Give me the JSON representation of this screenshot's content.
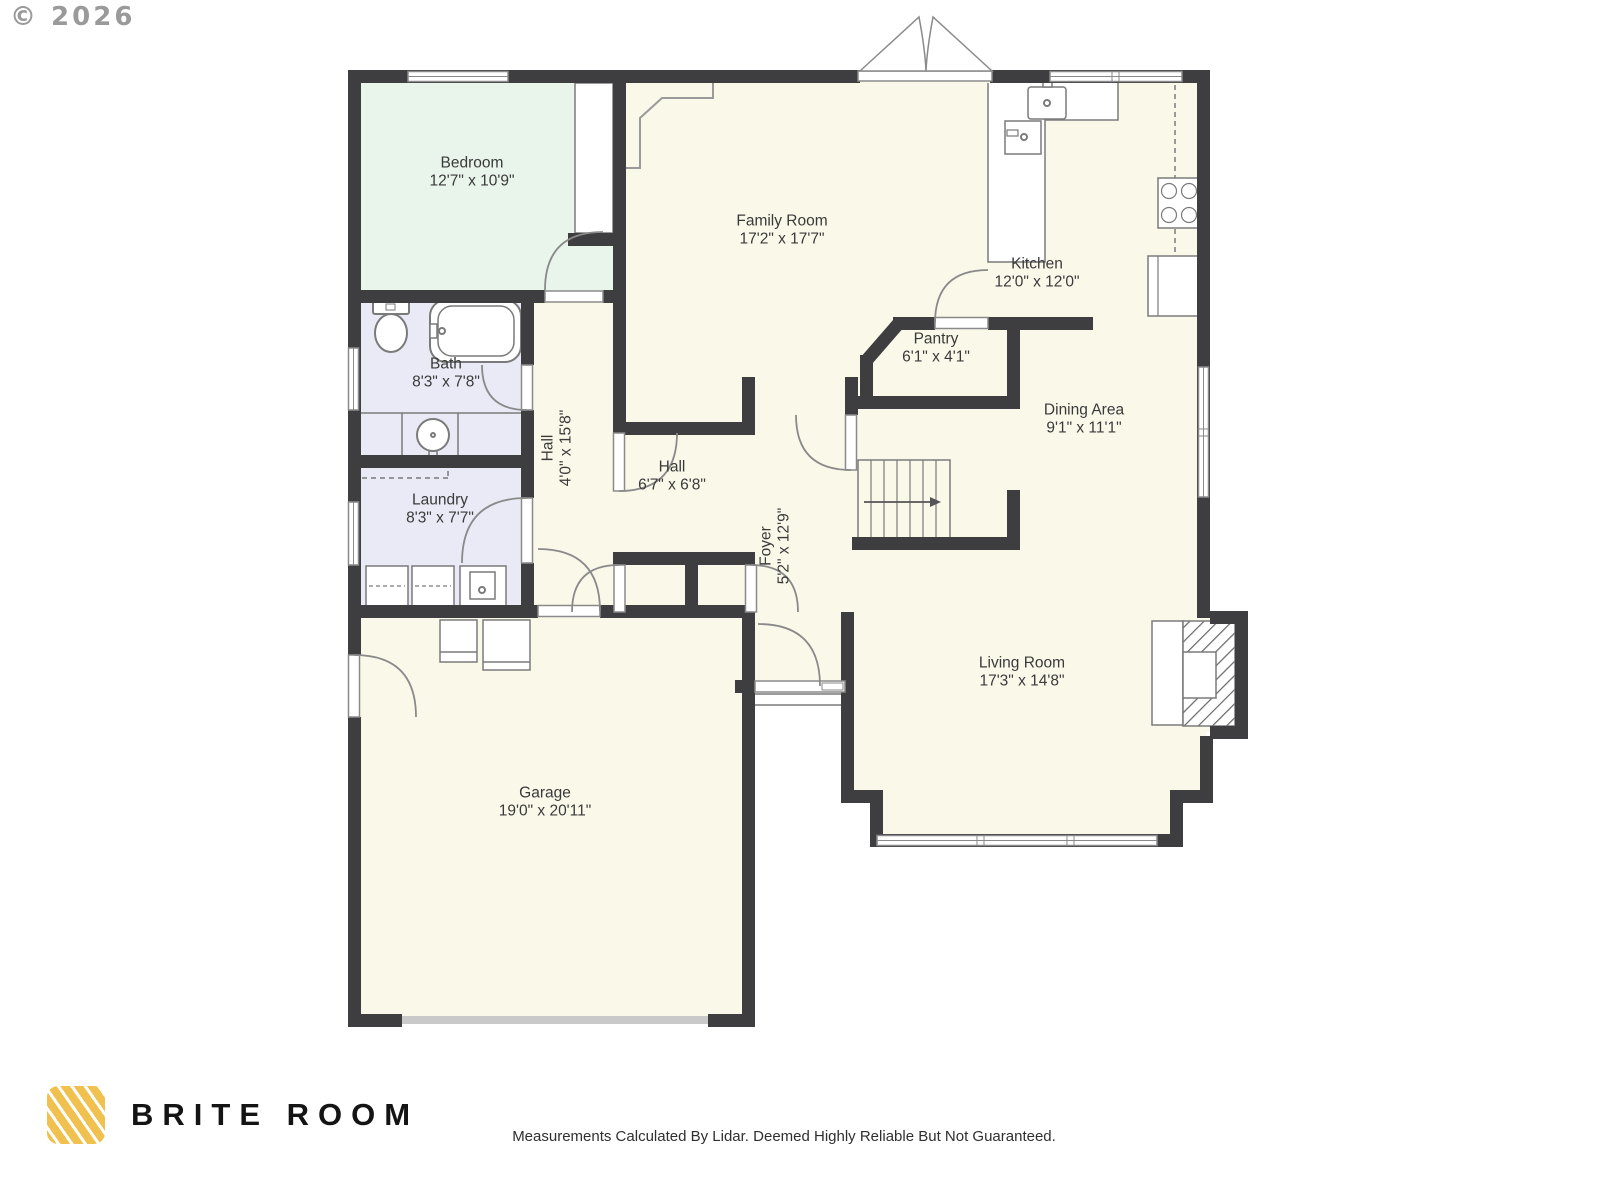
{
  "copyright": "© 2026",
  "brand": {
    "name": "BRITE ROOM"
  },
  "footer": {
    "disclaimer": "Measurements Calculated By Lidar. Deemed Highly Reliable But Not Guaranteed."
  },
  "rooms": [
    {
      "id": "bedroom",
      "name": "Bedroom",
      "dims": "12'7\" x 10'9\""
    },
    {
      "id": "family-room",
      "name": "Family Room",
      "dims": "17'2\" x 17'7\""
    },
    {
      "id": "kitchen",
      "name": "Kitchen",
      "dims": "12'0\" x 12'0\""
    },
    {
      "id": "pantry",
      "name": "Pantry",
      "dims": "6'1\" x 4'1\""
    },
    {
      "id": "dining-area",
      "name": "Dining Area",
      "dims": "9'1\" x 11'1\""
    },
    {
      "id": "bath",
      "name": "Bath",
      "dims": "8'3\" x 7'8\""
    },
    {
      "id": "laundry",
      "name": "Laundry",
      "dims": "8'3\" x 7'7\""
    },
    {
      "id": "hall-corridor",
      "name": "Hall",
      "dims": "4'0\" x 15'8\""
    },
    {
      "id": "hall",
      "name": "Hall",
      "dims": "6'7\" x 6'8\""
    },
    {
      "id": "foyer",
      "name": "Foyer",
      "dims": "5'2\" x 12'9\""
    },
    {
      "id": "living-room",
      "name": "Living Room",
      "dims": "17'3\" x 14'8\""
    },
    {
      "id": "garage",
      "name": "Garage",
      "dims": "19'0\" x 20'11\""
    }
  ],
  "colors": {
    "wall": "#3E3E41",
    "floor": "#FAF8E9",
    "bedroom_floor": "#E9F4EB",
    "bath_floor": "#E9EAF5",
    "logo_yellow": "#F1C14F"
  }
}
